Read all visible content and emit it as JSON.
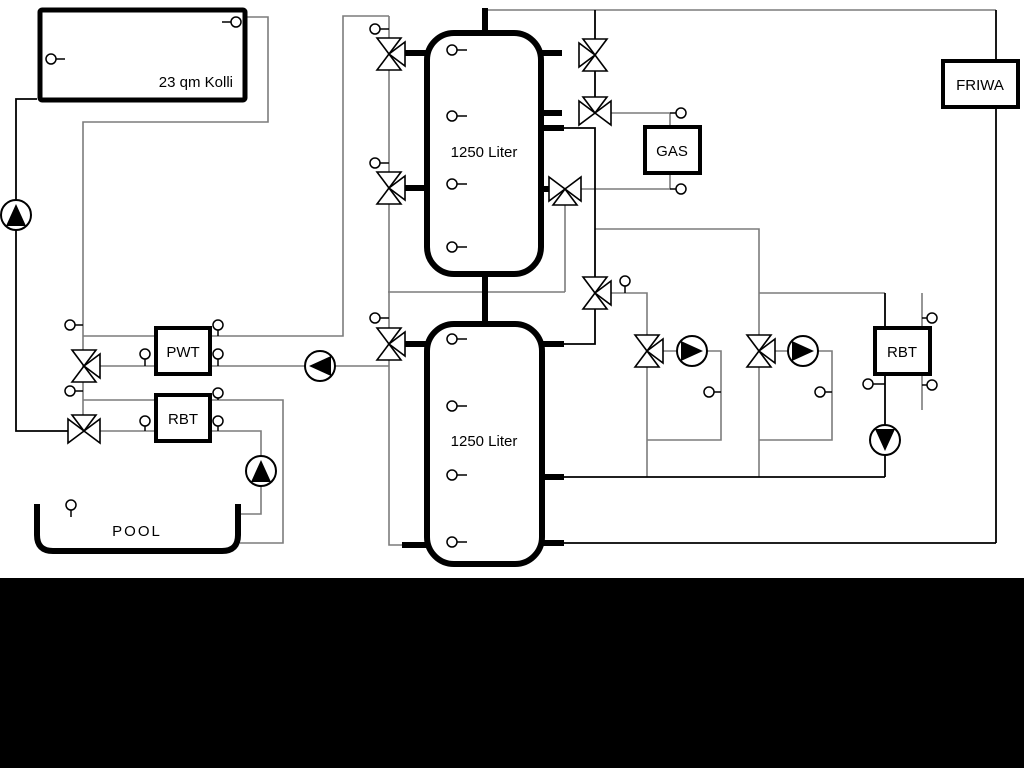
{
  "diagram": {
    "type": "hydraulic-schematic",
    "background": "#ffffff",
    "footer_bar_color": "#000000",
    "pipe_gray": "#7c7c7c",
    "pipe_black": "#000000",
    "labels": {
      "collector": "23 qm Kolli",
      "upper_tank": "1250 Liter",
      "lower_tank": "1250 Liter",
      "plate_heat_exchanger": "PWT",
      "pool_heat_exchanger": "RBT",
      "heating_heat_exchanger": "RBT",
      "boiler": "GAS",
      "fresh_water_station": "FRIWA",
      "pool": "POOL"
    }
  }
}
